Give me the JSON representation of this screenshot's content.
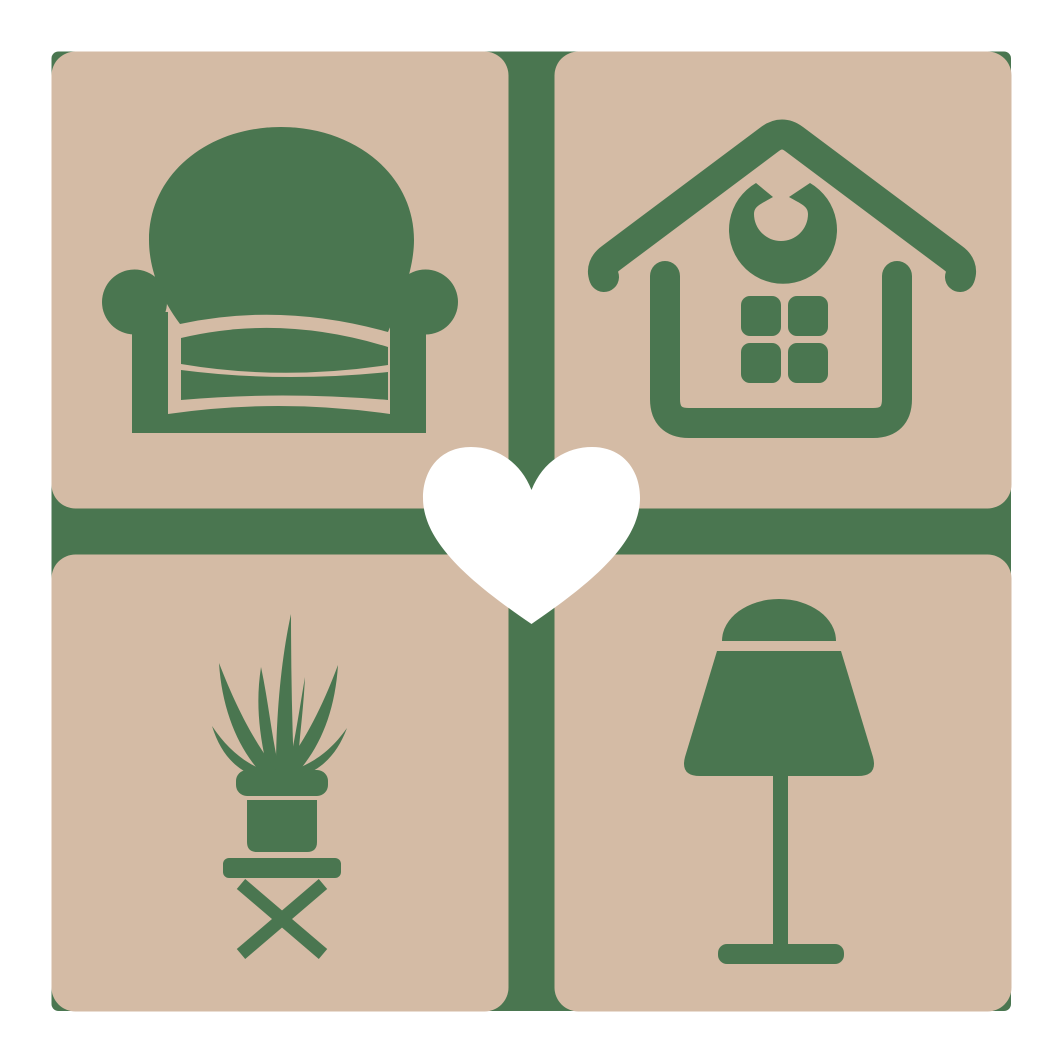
{
  "logo": {
    "name": "home-decor-heart-logo",
    "description": "Four rounded tiles with furniture icons around a central heart",
    "colors": {
      "page_background": "#ffffff",
      "backplate_green": "#4a7650",
      "tile_tan": "#d4bba5",
      "heart_white": "#ffffff"
    },
    "tiles": [
      {
        "position": "top-left",
        "icon": "armchair-icon"
      },
      {
        "position": "top-right",
        "icon": "house-icon"
      },
      {
        "position": "bottom-left",
        "icon": "potted-plant-icon"
      },
      {
        "position": "bottom-right",
        "icon": "table-lamp-icon"
      }
    ],
    "center_icon": "heart-icon"
  }
}
